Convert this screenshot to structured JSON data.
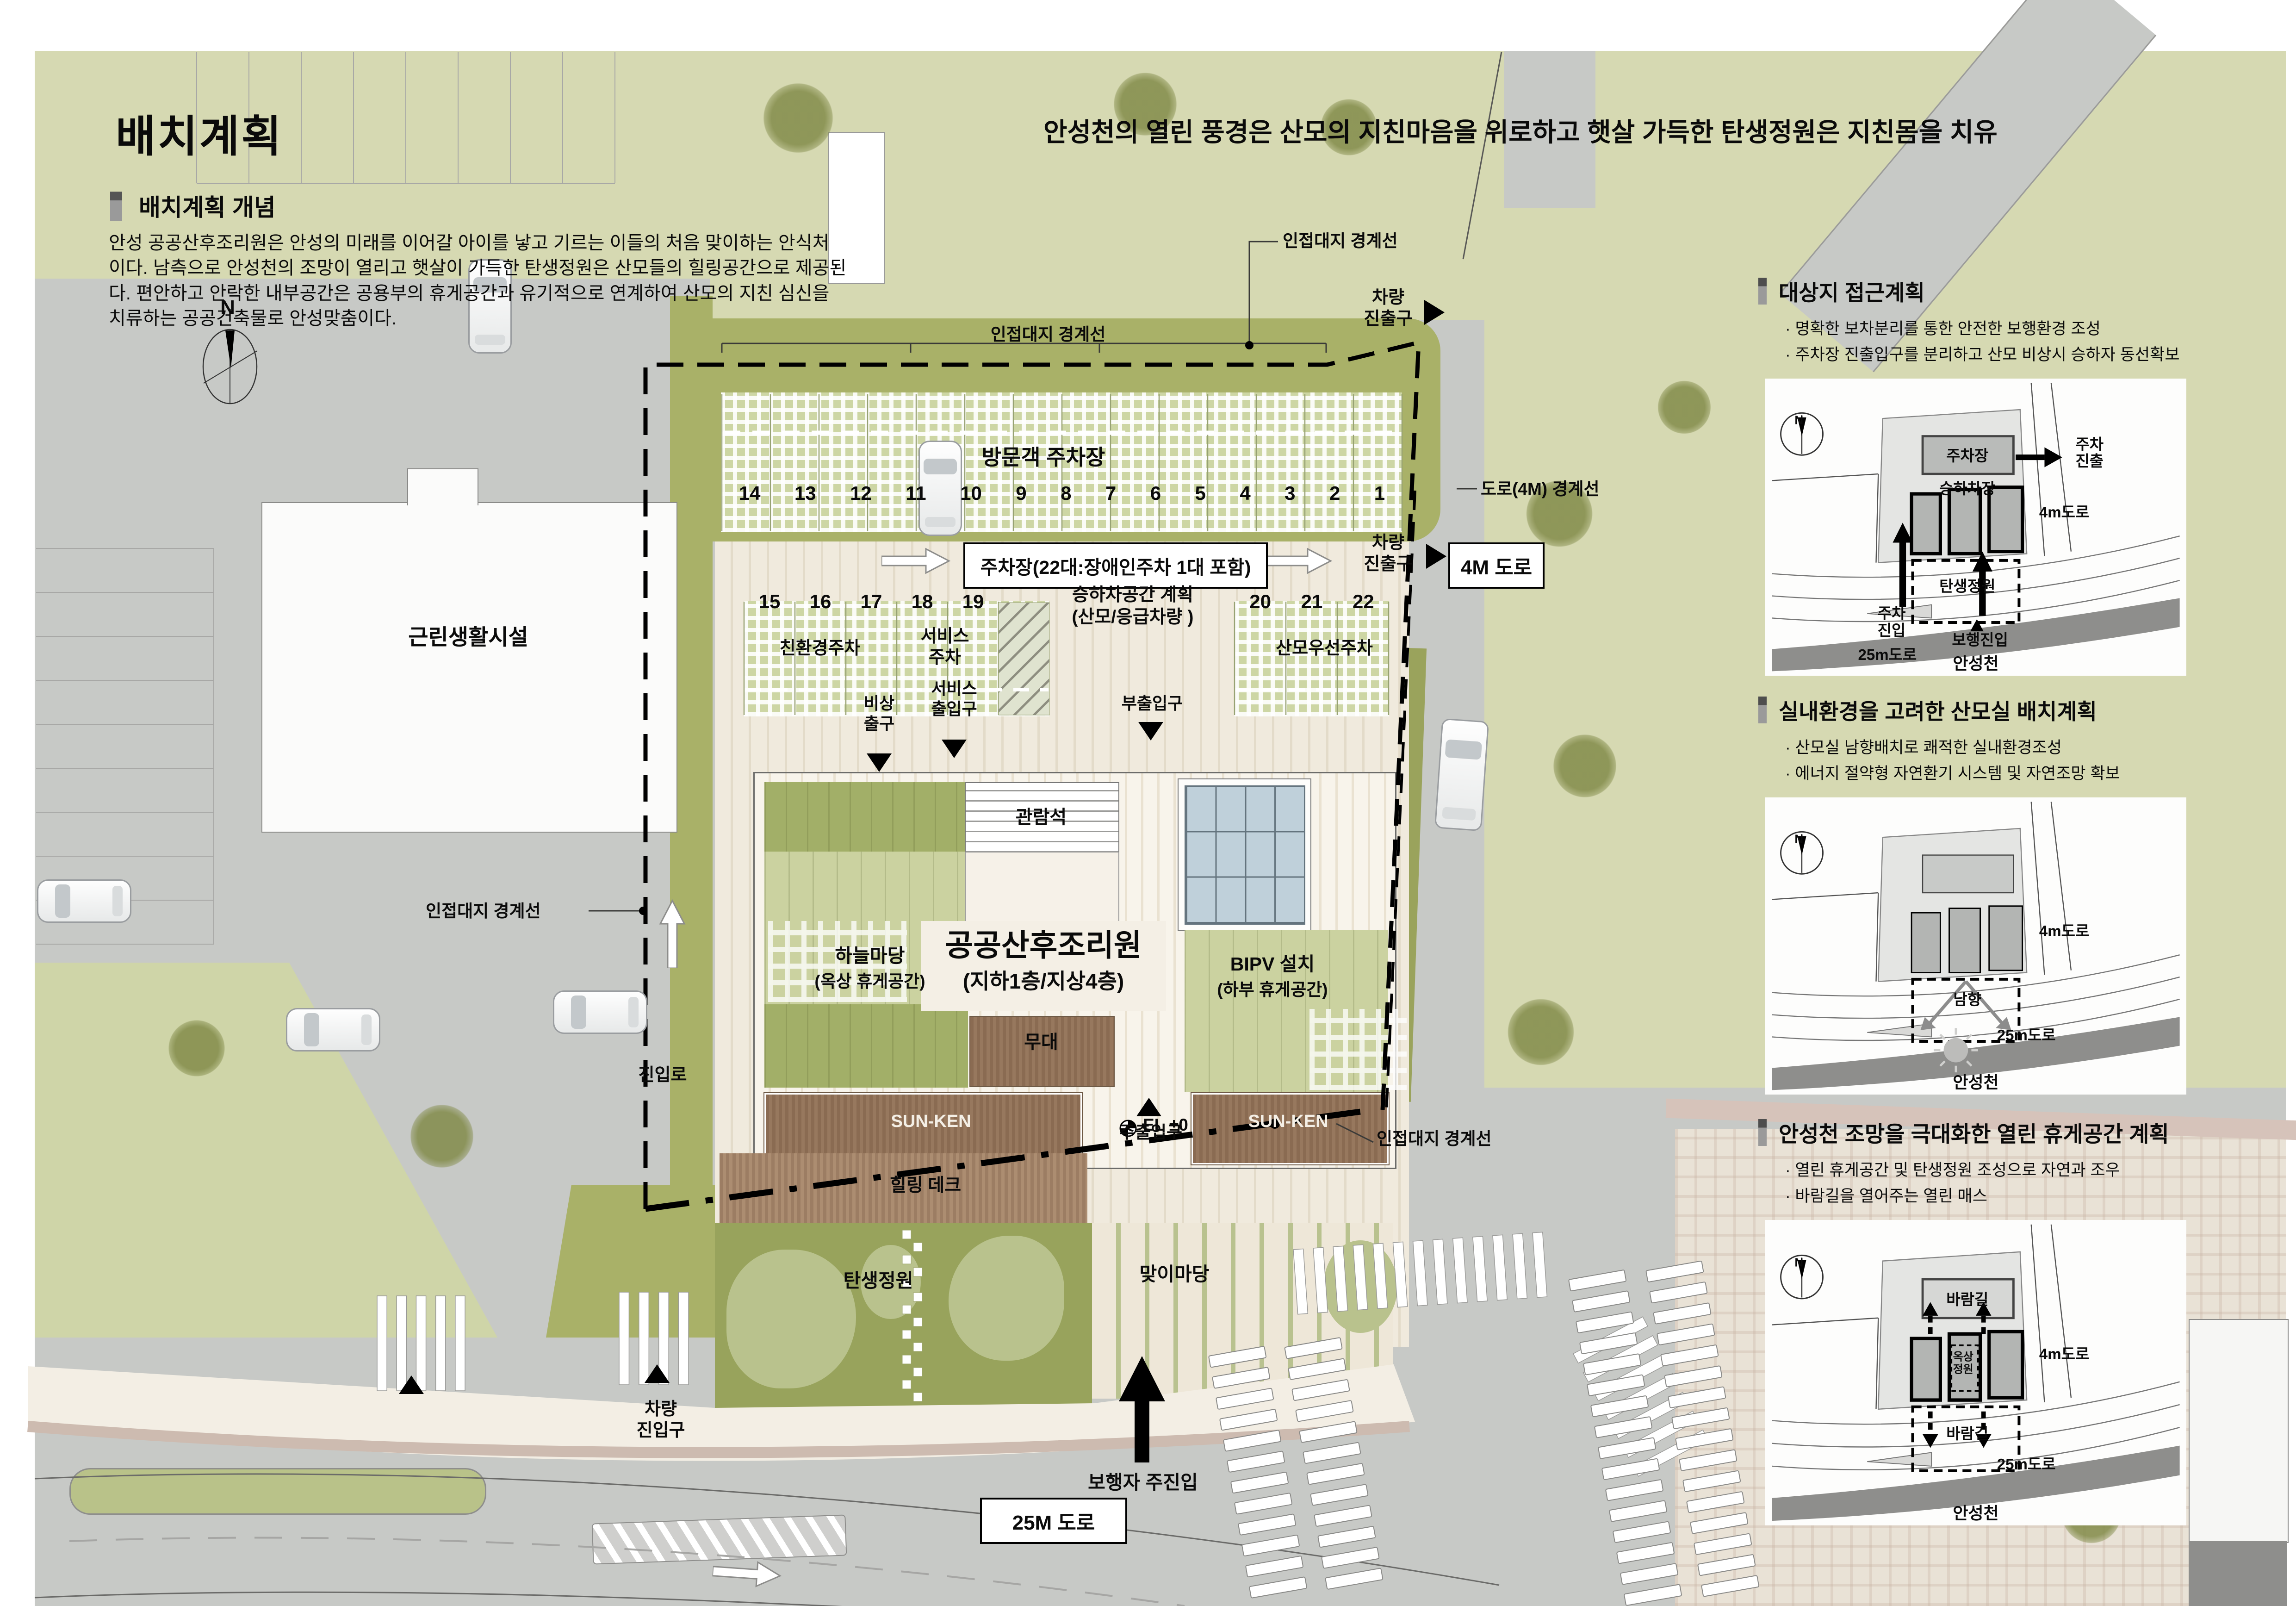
{
  "page": {
    "title": "배치계획",
    "headline": "안성천의 열린 풍경은 산모의 지친마음을 위로하고  햇살 가득한 탄생정원은 지친몸을 치유",
    "concept_heading": "배치계획 개념",
    "concept_body": "안성 공공산후조리원은 안성의 미래를 이어갈 아이를 낳고 기르는 이들의 처음 맞이하는 안식처 이다. 남측으로 안성천의 조망이 열리고 햇살이 가득한 탄생정원은 산모들의 힐링공간으로 제공된다. 편안하고 안락한 내부공간은 공용부의 휴게공간과 유기적으로 연계하여 산모의 지친 심신을 치류하는 공공건축물로 안성맞춤이다."
  },
  "plan": {
    "labels": {
      "visitor_parking": "방문객 주차장",
      "parking_note": "주차장(22대:장애인주차 1대 포함)",
      "boundary": "인접대지 경계선",
      "vehicle_exit": "차량\n진출구",
      "road4m_boundary": "도로(4M) 경계선",
      "road4m": "4M 도로",
      "road25m": "25M 도로",
      "vehicle_entry": "차량\n진입구",
      "neighborhood": "근린생활시설",
      "access_road": "진입로",
      "dropoff": "승하차공간 계획\n(산모/응급차량 )",
      "eco": "친환경주차",
      "service_pk": "서비스\n주차",
      "mother_pk": "산모우선주차",
      "emergency": "비상\n출구",
      "service_ent": "서비스\n출입구",
      "sub_ent": "부출입구",
      "seats": "관람석",
      "bld_name": "공공산후조리원",
      "bld_floor": "(지하1층/지상4층)",
      "sky1": "하늘마당",
      "sky2": "(옥상 휴게공간)",
      "bipv1": "BIPV 설치",
      "bipv2": "(하부 휴게공간)",
      "stage": "무대",
      "sunken": "SUN-KEN",
      "main_ent": "주출입구",
      "deck": "힐링 데크",
      "el": "EL ±0",
      "garden": "탄생정원",
      "yard": "맞이마당",
      "ped": "보행자 주진입",
      "compass": "N"
    },
    "row1": [
      "14",
      "13",
      "12",
      "11",
      "10",
      "9",
      "8",
      "7",
      "6",
      "5",
      "4",
      "3",
      "2",
      "1"
    ],
    "row2": [
      "15",
      "16",
      "17",
      "18",
      "19"
    ],
    "row3": [
      "20",
      "21",
      "22"
    ]
  },
  "panels": [
    {
      "title": "대상지 접근계획",
      "bullets": [
        "· 명확한 보차분리를 통한 안전한 보행환경 조성",
        "· 주차장 진출입구를 분리하고 산모 비상시 승하자 동선확보"
      ],
      "diagram": {
        "n": "N",
        "parking": "주차장",
        "parking_exit": "주차\n진출",
        "dropzone": "승하차장",
        "road4m": "4m도로",
        "garden": "탄생정원",
        "parking_entry": "주차\n진입",
        "ped_entry": "보행진입",
        "road25m": "25m도로",
        "river": "안성천"
      }
    },
    {
      "title": "실내환경을 고려한 산모실 배치계획",
      "bullets": [
        "· 산모실 남향배치로 쾌적한 실내환경조성",
        "· 에너지 절약형 자연환기 시스템 및 자연조망 확보"
      ],
      "diagram": {
        "n": "N",
        "south": "남향",
        "road4m": "4m도로",
        "road25m": "25m도로",
        "river": "안성천"
      }
    },
    {
      "title": "안성천 조망을 극대화한 열린 휴게공간 계획",
      "bullets": [
        "· 열린 휴게공간 및 탄생정원 조성으로 자연과 조우",
        "· 바람길을 열어주는 열린 매스"
      ],
      "diagram": {
        "n": "N",
        "wind_top": "바람길",
        "roof_garden": "옥상\n정원",
        "road4m": "4m도로",
        "wind_bottom": "바람길",
        "road25m": "25m도로",
        "river": "안성천"
      }
    }
  ]
}
